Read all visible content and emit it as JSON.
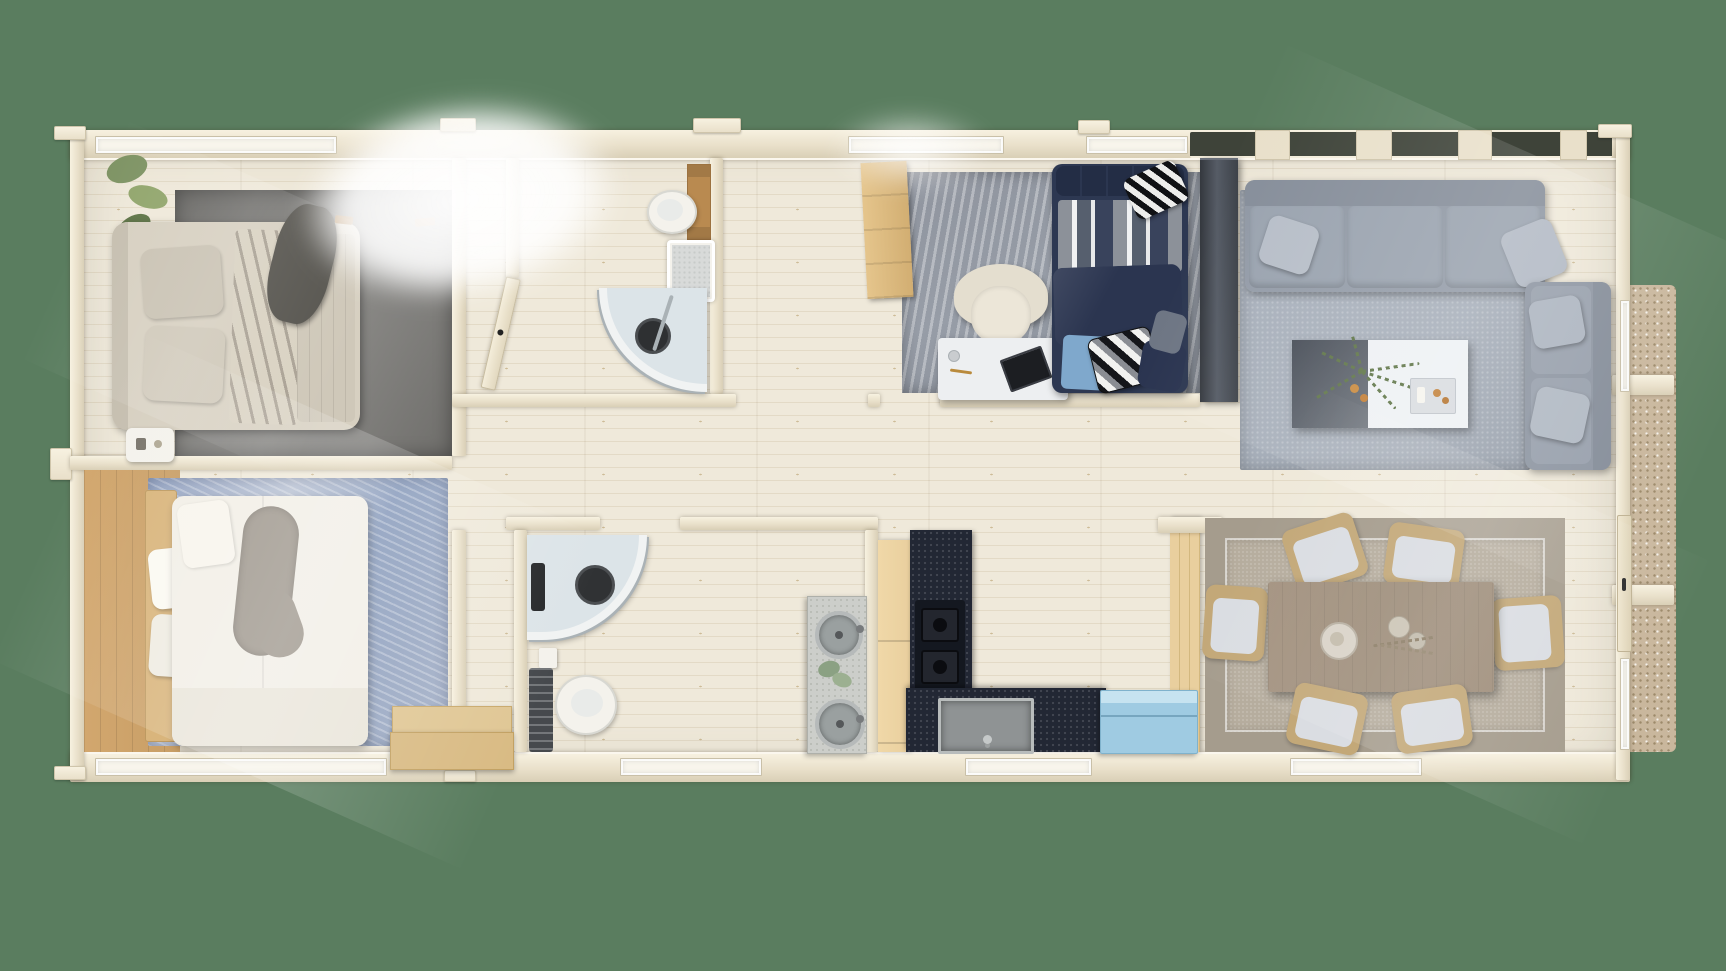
{
  "scene": {
    "type": "3d-floor-plan-top-view",
    "description": "Top-down 3D architectural render of a single-storey log cabin with two bedrooms, two shower bathrooms, office/guest room, living room, kitchen and dining area",
    "background_color": "#5a7d5f"
  },
  "palette": {
    "bg": "#5a7d5f",
    "wall": "#e9e0ca",
    "wallHi": "#f7f1e0",
    "wallSh": "#d9cfb6",
    "floor": "#efe9da",
    "floorLine": "#e3dac6",
    "knot": "#cdbb97",
    "rugDark": "#73726f",
    "rugDarkHi": "#8b8a87",
    "rugBlue": "#93a3c2",
    "rugBlueHi": "#bcc5d6",
    "rugOffice": "#979da7",
    "rugLiving": "#a7afba",
    "rugDiningBorder": "#a59c8d",
    "rugDiningField": "#b6ad9e",
    "sofa": "#949ca8",
    "sofaDark": "#868e9a",
    "pillow": "#b7bec8",
    "navy": "#2d3852",
    "navyDeep": "#232d45",
    "lightBlue": "#7fa8cc",
    "bedCream": "#d7d0c1",
    "bedWhite": "#f2efe7",
    "throwDark": "#56544e",
    "throwGray": "#a19a90",
    "white": "#f4f2ec",
    "desk": "#edeff1",
    "granite": "#222734",
    "graniteDeep": "#141820",
    "sinkGray": "#8f9394",
    "woodCab": "#e9cf9e",
    "woodAccent": "#c89e66",
    "woodStep": "#e0c795",
    "chestBlue": "#9fcbe2",
    "chestBlueHi": "#c6e3f0",
    "gravel": "#c9b79d",
    "glass": "#c8d6de",
    "chrome": "#aab2b6",
    "plant": "#7f9465",
    "plantDeep": "#5f7547",
    "tableWood": "#9e8e7b",
    "chairWood": "#c3a878",
    "chairCushion": "#dadde2",
    "vanity": "#ccceca",
    "concrete": "#9aa0a0",
    "radiator": "#46494d",
    "wardrobe1": "#34383e",
    "wardrobe2": "#565c66",
    "skylight": "#3e4339"
  },
  "rooms": [
    {
      "id": "bedroom-1",
      "furniture": [
        "double-bed-beige",
        "dark-gray-rug",
        "hanging-plant",
        "nightstand",
        "wall-hooks"
      ]
    },
    {
      "id": "bedroom-2",
      "furniture": [
        "double-bed-white",
        "blue-distressed-rug",
        "wood-headboard-bench",
        "pillows",
        "gray-throw"
      ]
    },
    {
      "id": "bathroom-1",
      "furniture": [
        "corner-shower",
        "shower-tray",
        "toilet",
        "wood-cabinet"
      ]
    },
    {
      "id": "hallway-entry",
      "furniture": [
        "entry-steps"
      ]
    },
    {
      "id": "bathroom-2",
      "furniture": [
        "corner-shower",
        "toilet",
        "radiator",
        "double-round-sink-vanity",
        "eucalyptus-plant"
      ]
    },
    {
      "id": "kitchen",
      "furniture": [
        "l-shaped-granite-counter",
        "gas-hob",
        "stone-basin-sink",
        "wood-cabinets",
        "light-blue-chest-freezer"
      ]
    },
    {
      "id": "office-guest-room",
      "furniture": [
        "navy-daybed",
        "striped-pillows",
        "cream-armchair",
        "white-desk",
        "wood-dresser",
        "dark-wardrobe",
        "distressed-gray-rug"
      ]
    },
    {
      "id": "living-room",
      "furniture": [
        "gray-corner-sofa",
        "throw-pillows",
        "two-tone-coffee-table",
        "fern-plant",
        "gray-rug"
      ]
    },
    {
      "id": "dining-room",
      "furniture": [
        "wood-dining-table",
        "six-chairs",
        "bordered-rug",
        "wood-partition",
        "centerpiece-plates"
      ]
    }
  ],
  "exterior": {
    "walls": "cream log construction with protruding corner joints",
    "windows": "white-framed windows on all facades",
    "skylights": "dark roof glazing strip over living room",
    "terrace": "gravel strip along right facade",
    "entry_door": "right wall with dark handle",
    "sunlight": "bright overexposed glare top-centre and diagonal light rays"
  }
}
